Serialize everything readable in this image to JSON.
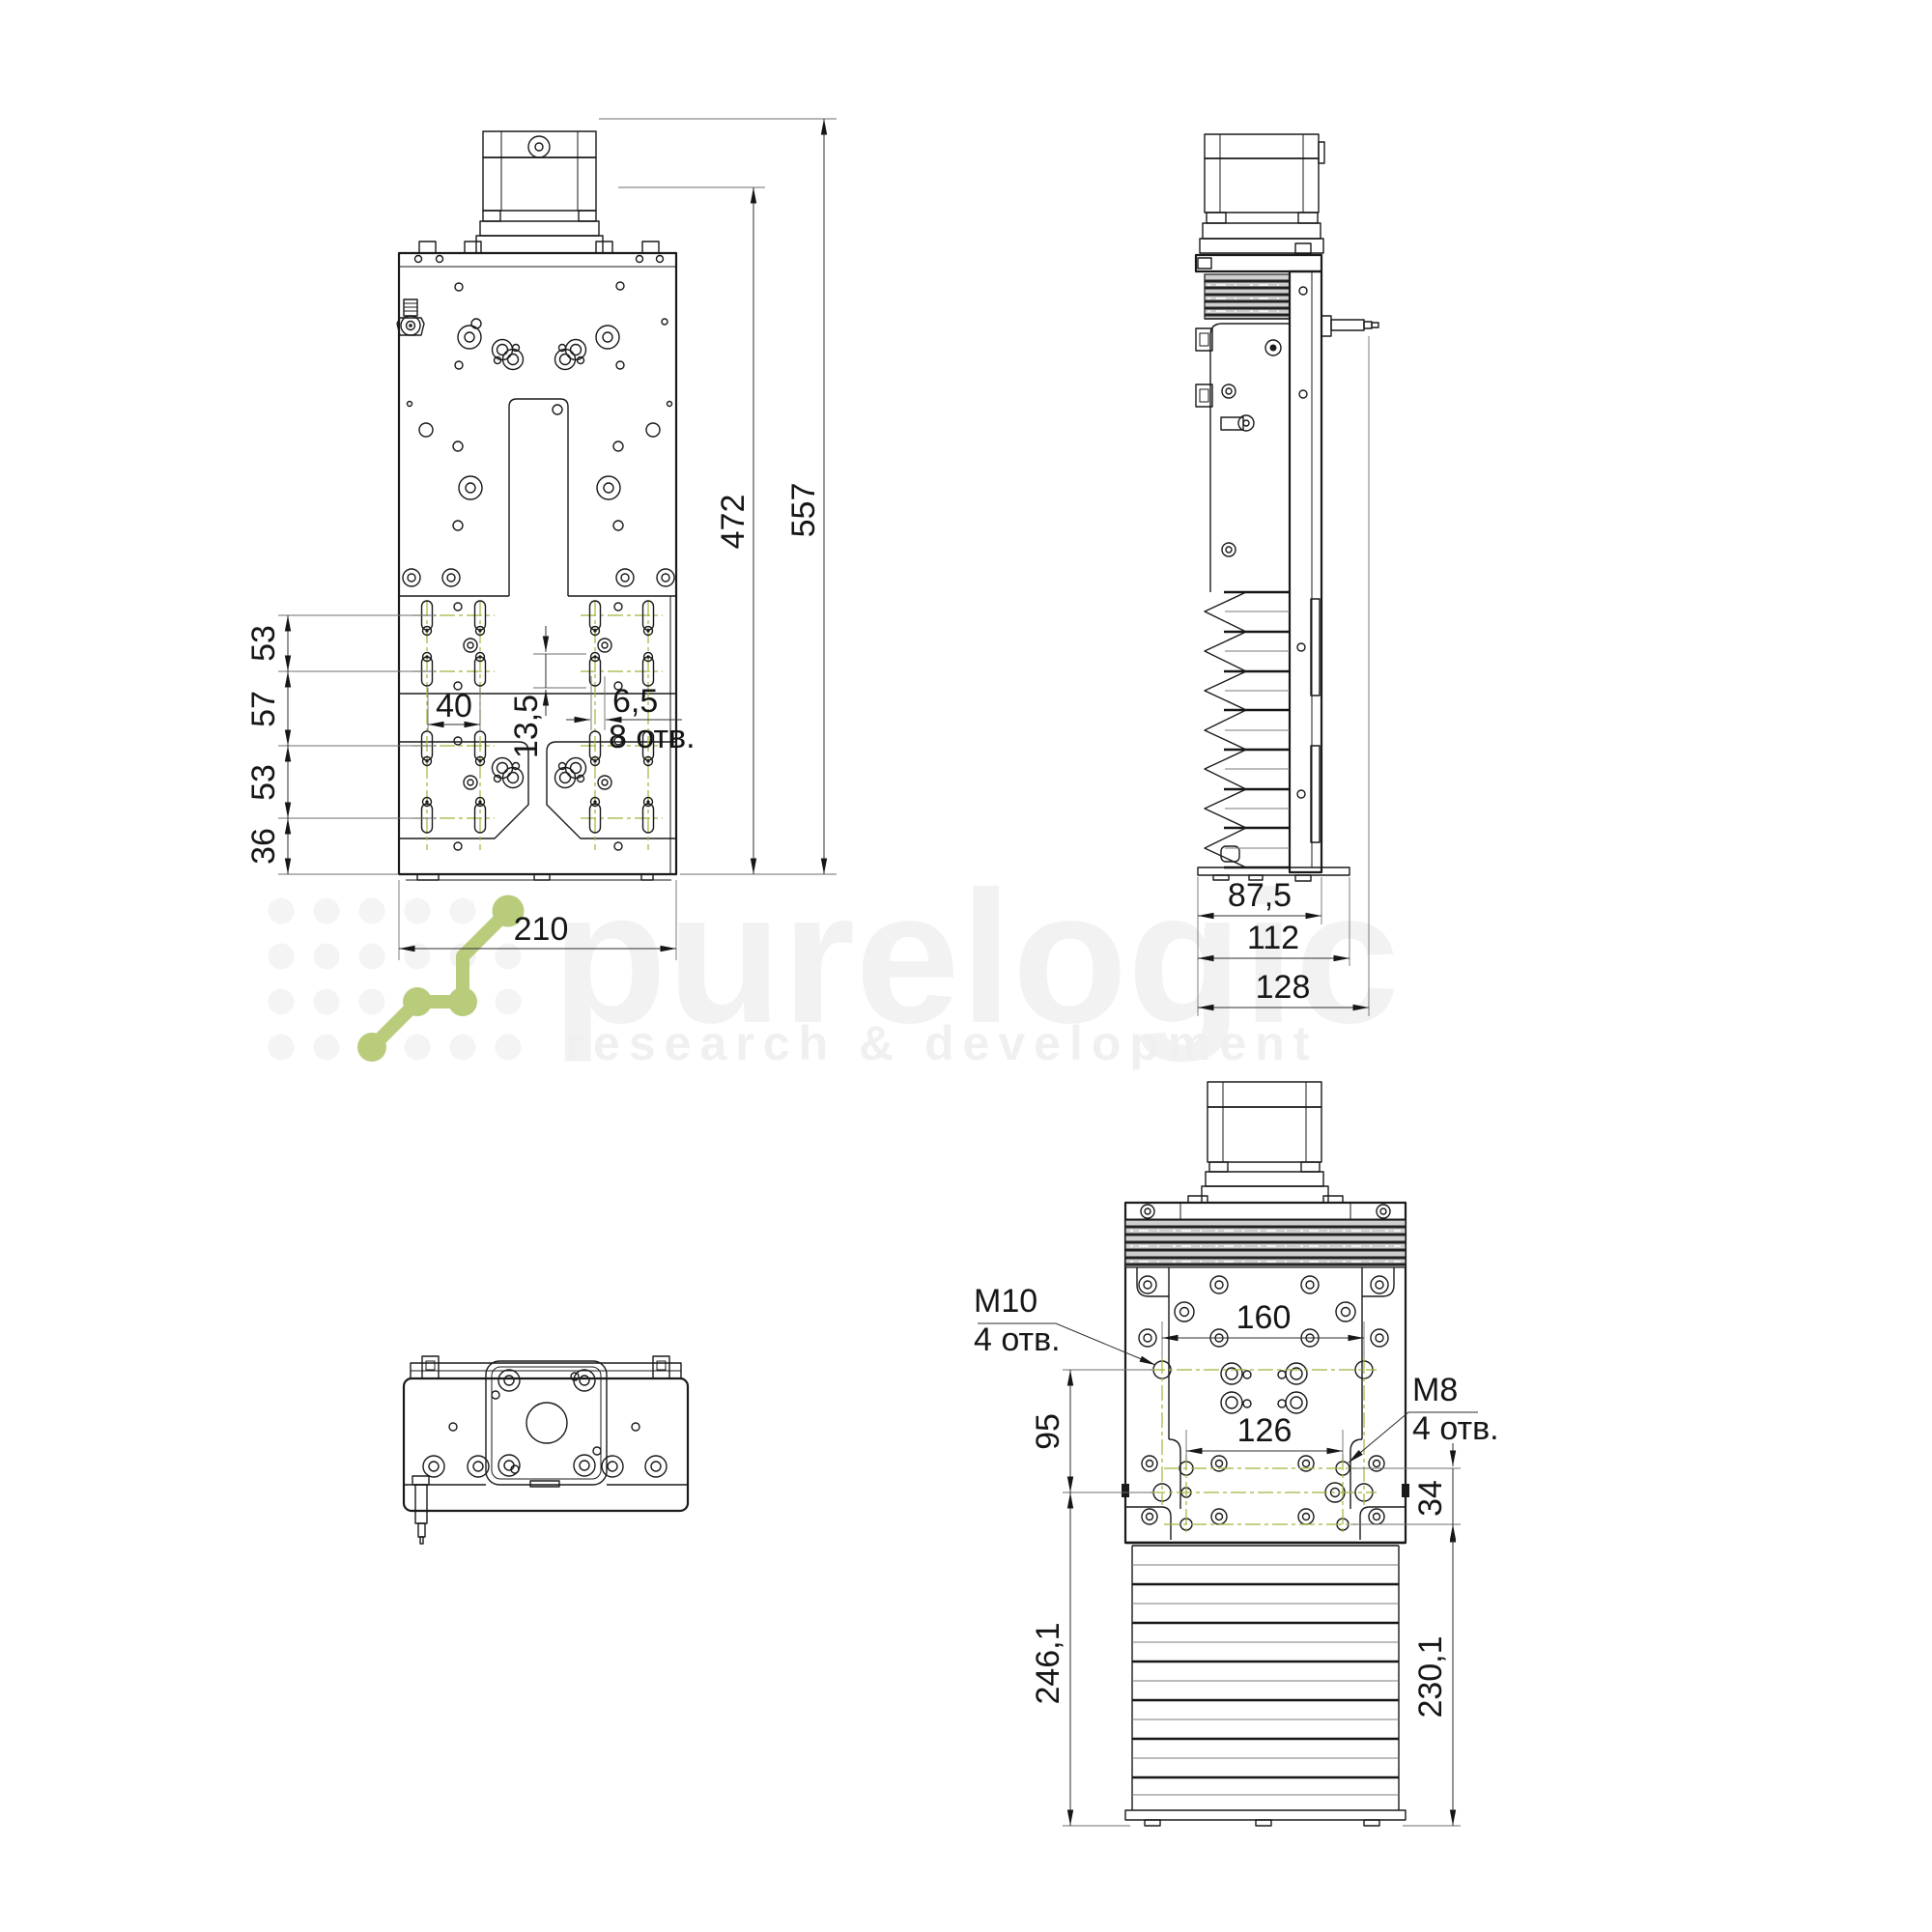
{
  "watermark": {
    "brand": "purelogic",
    "tagline": "research & development"
  },
  "front_view": {
    "row_spacing_top": "53",
    "row_spacing_mid": "57",
    "row_spacing_low": "53",
    "row_spacing_bottom": "36",
    "slot_pitch": "40",
    "slot_offset": "13,5",
    "slot_width": "6,5",
    "slot_count": "8 отв.",
    "width": "210",
    "body_height": "472",
    "total_height": "557"
  },
  "side_view": {
    "body_depth": "87,5",
    "base_depth": "112",
    "overall_depth": "128"
  },
  "rear_view": {
    "top_thread": "M10",
    "top_thread_count": "4 отв.",
    "top_hole_span": "160",
    "bottom_thread": "M8",
    "bottom_thread_count": "4 отв.",
    "bottom_hole_span": "126",
    "hole_rows_spacing": "95",
    "rows_offset": "34",
    "left_height": "246,1",
    "right_height": "230,1"
  },
  "colors": {
    "accent_green": "#b9cc7c",
    "centerline_green": "#9fb43e",
    "line": "#1a1a1a",
    "watermark_gray": "#f2f2f2"
  }
}
